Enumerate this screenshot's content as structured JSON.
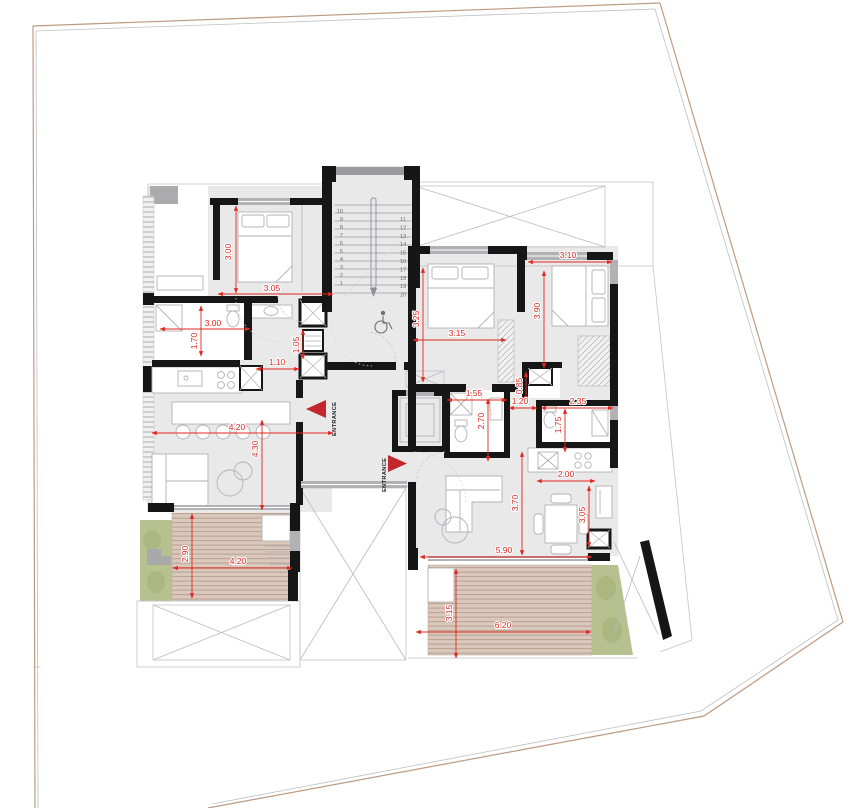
{
  "plan": {
    "entrance_label_a": "ENTRANCE",
    "entrance_label_b": "ENTRANCE"
  },
  "icons": {
    "wheelchair": "wheelchair-accessibility-symbol"
  },
  "colors": {
    "dimension_red": "#e02820",
    "wall_black": "#161616",
    "deck_wood": "#d9c8bb",
    "deck_stripe": "#b9a190",
    "planter_green": "#b7c08f",
    "boundary_tan": "#bd9a82",
    "floor_gray": "#e9e9ea"
  },
  "stairs": {
    "left": {
      "x": 343,
      "y0": 213,
      "step": 8,
      "anchor": "end",
      "values": [
        "10",
        "9",
        "8",
        "7",
        "6",
        "5",
        "4",
        "3",
        "2",
        "1"
      ]
    },
    "right": {
      "x": 400,
      "y0": 221,
      "step": 8.4,
      "anchor": "start",
      "values": [
        "11",
        "12",
        "13",
        "14",
        "15",
        "16",
        "17",
        "18",
        "19",
        "20"
      ]
    }
  },
  "dimensions": [
    {
      "value": "3.00",
      "x": 231,
      "y": 252,
      "rot": -90,
      "x1": 236,
      "y1": 206,
      "x2": 236,
      "y2": 293
    },
    {
      "value": "3.05",
      "x": 272,
      "y": 291,
      "rot": 0,
      "x1": 218,
      "y1": 294,
      "x2": 333,
      "y2": 294
    },
    {
      "value": "3.00",
      "x": 213,
      "y": 326,
      "rot": 0,
      "x1": 160,
      "y1": 329,
      "x2": 250,
      "y2": 329
    },
    {
      "value": "1.70",
      "x": 197,
      "y": 341,
      "rot": -90,
      "x1": 201,
      "y1": 306,
      "x2": 201,
      "y2": 356
    },
    {
      "value": "1.05",
      "x": 299,
      "y": 345,
      "rot": -90,
      "x1": 303,
      "y1": 330,
      "x2": 303,
      "y2": 359
    },
    {
      "value": "1.10",
      "x": 277,
      "y": 365,
      "rot": 0,
      "x1": 256,
      "y1": 369,
      "x2": 299,
      "y2": 369
    },
    {
      "value": "4.20",
      "x": 237,
      "y": 430,
      "rot": 0,
      "x1": 152,
      "y1": 433,
      "x2": 333,
      "y2": 433
    },
    {
      "value": "4.30",
      "x": 258,
      "y": 449,
      "rot": -90,
      "x1": 262,
      "y1": 420,
      "x2": 262,
      "y2": 510
    },
    {
      "value": "2.90",
      "x": 188,
      "y": 554,
      "rot": -90,
      "x1": 192,
      "y1": 514,
      "x2": 192,
      "y2": 598
    },
    {
      "value": "4.20",
      "x": 238,
      "y": 564,
      "rot": 0,
      "x1": 173,
      "y1": 568,
      "x2": 292,
      "y2": 568
    },
    {
      "value": "3.25",
      "x": 419,
      "y": 319,
      "rot": -90,
      "x1": 423,
      "y1": 268,
      "x2": 423,
      "y2": 382
    },
    {
      "value": "3.15",
      "x": 457,
      "y": 336,
      "rot": 0,
      "x1": 413,
      "y1": 340,
      "x2": 506,
      "y2": 340
    },
    {
      "value": "3.10",
      "x": 568,
      "y": 258,
      "rot": 0,
      "x1": 528,
      "y1": 262,
      "x2": 612,
      "y2": 262
    },
    {
      "value": "3.90",
      "x": 540,
      "y": 311,
      "rot": -90,
      "x1": 544,
      "y1": 271,
      "x2": 544,
      "y2": 368
    },
    {
      "value": "0.85",
      "x": 522,
      "y": 386,
      "rot": -90,
      "x1": 526,
      "y1": 372,
      "x2": 526,
      "y2": 401
    },
    {
      "value": "1.55",
      "x": 474,
      "y": 396,
      "rot": 0,
      "x1": 447,
      "y1": 400,
      "x2": 507,
      "y2": 400
    },
    {
      "value": "2.70",
      "x": 484,
      "y": 421,
      "rot": -90,
      "x1": 488,
      "y1": 399,
      "x2": 488,
      "y2": 461
    },
    {
      "value": "1.20",
      "x": 520,
      "y": 404,
      "rot": 0,
      "x1": 509,
      "y1": 408,
      "x2": 537,
      "y2": 408
    },
    {
      "value": "2.35",
      "x": 578,
      "y": 404,
      "rot": 0,
      "x1": 541,
      "y1": 408,
      "x2": 613,
      "y2": 408
    },
    {
      "value": "1.75",
      "x": 561,
      "y": 425,
      "rot": -90,
      "x1": 565,
      "y1": 409,
      "x2": 565,
      "y2": 452
    },
    {
      "value": "2.00",
      "x": 566,
      "y": 477,
      "rot": 0,
      "x1": 537,
      "y1": 481,
      "x2": 595,
      "y2": 481
    },
    {
      "value": "3.05",
      "x": 585,
      "y": 515,
      "rot": -90,
      "x1": 589,
      "y1": 486,
      "x2": 589,
      "y2": 547
    },
    {
      "value": "3.70",
      "x": 518,
      "y": 503,
      "rot": -90,
      "x1": 522,
      "y1": 452,
      "x2": 522,
      "y2": 555
    },
    {
      "value": "5.90",
      "x": 504,
      "y": 553,
      "rot": 0,
      "x1": 420,
      "y1": 557,
      "x2": 592,
      "y2": 557
    },
    {
      "value": "3.15",
      "x": 452,
      "y": 613,
      "rot": -90,
      "x1": 456,
      "y1": 569,
      "x2": 456,
      "y2": 658
    },
    {
      "value": "6.20",
      "x": 503,
      "y": 628,
      "rot": 0,
      "x1": 416,
      "y1": 632,
      "x2": 591,
      "y2": 632
    }
  ]
}
